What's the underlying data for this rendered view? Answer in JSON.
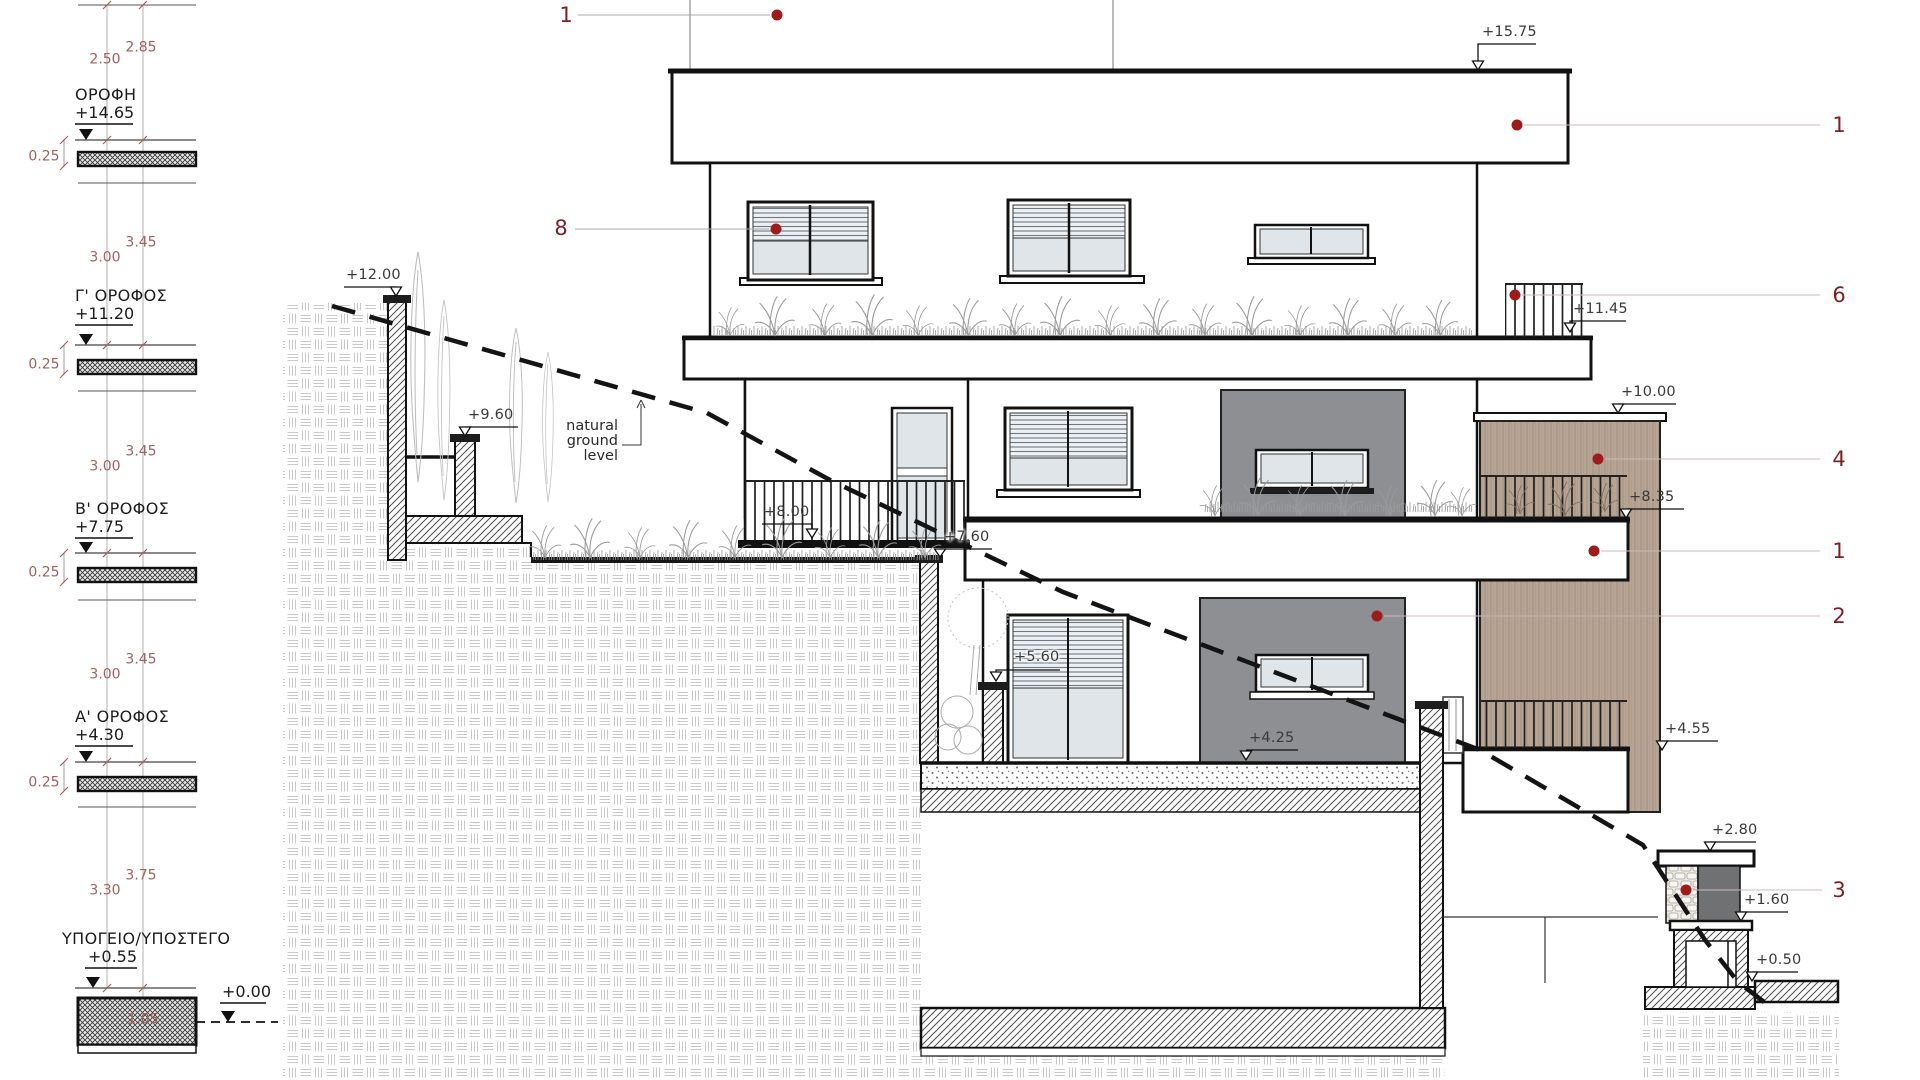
{
  "legend": {
    "levels": [
      {
        "name": "ΟΡΟΦΗ",
        "elev": "+14.65",
        "dims": [
          "2.50",
          "2.85"
        ],
        "slab_dim": "0.25"
      },
      {
        "name": "Γ' ΟΡΟΦΟΣ",
        "elev": "+11.20",
        "dims": [
          "3.00",
          "3.45"
        ],
        "slab_dim": "0.25"
      },
      {
        "name": "Β' ΟΡΟΦΟΣ",
        "elev": "+7.75",
        "dims": [
          "3.00",
          "3.45"
        ],
        "slab_dim": "0.25"
      },
      {
        "name": "Α' ΟΡΟΦΟΣ",
        "elev": "+4.30",
        "dims": [
          "3.00",
          "3.45"
        ],
        "slab_dim": "0.25"
      },
      {
        "name": "ΥΠΟΓΕΙΟ/ΥΠΟΣΤΕΓΟ",
        "elev": "+0.55",
        "dims": [
          "3.30",
          "3.75"
        ],
        "slab_dim": "1.05"
      }
    ],
    "datum": "+0.00"
  },
  "markers": {
    "m15_75": "+15.75",
    "m12_00": "+12.00",
    "m11_45": "+11.45",
    "m10_00": "+10.00",
    "m9_60": "+9.60",
    "m8_35": "+8.35",
    "m8_00": "+8.00",
    "m7_60": "+7.60",
    "m5_60": "+5.60",
    "m4_55": "+4.55",
    "m4_25": "+4.25",
    "m2_80": "+2.80",
    "m1_60": "+1.60",
    "m0_50": "+0.50"
  },
  "refs": {
    "top1": "1",
    "left8": "8",
    "r1a": "1",
    "r6": "6",
    "r4": "4",
    "r1b": "1",
    "r2": "2",
    "r3": "3"
  },
  "annotations": {
    "ngl": [
      "natural",
      "ground",
      "level"
    ]
  },
  "colors": {
    "label_red": "#7e2023",
    "dim_red": "#a2605c",
    "dot_red": "#9e1b1b",
    "panel_gray": "#8d8f92",
    "wood": "#b7a494",
    "glass": "#dfe5e9",
    "dark_panel": "#6f7173"
  }
}
